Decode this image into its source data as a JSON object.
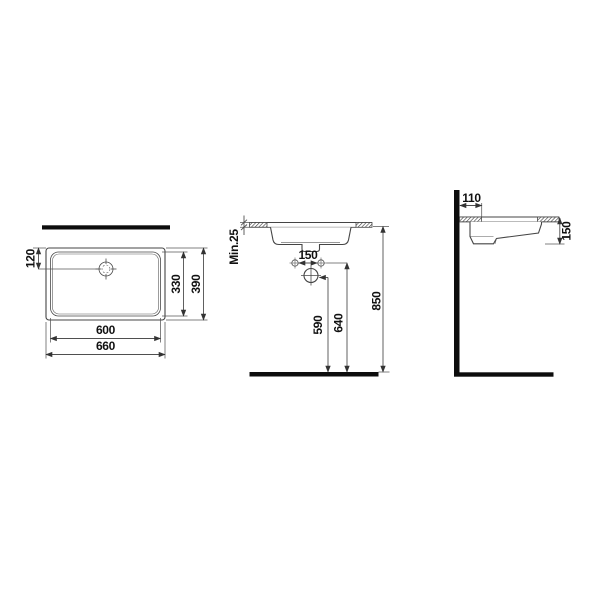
{
  "drawing": {
    "kind": "washbasin-dimension-drawing",
    "colors": {
      "background": "#ffffff",
      "solid_bar": "#0d0d0d",
      "line": "#454545",
      "text": "#111111"
    },
    "views": {
      "plan": {
        "dims": {
          "drain_offset": "120",
          "inner_depth": "330",
          "outer_depth": "390",
          "inner_width": "600",
          "outer_width": "660"
        }
      },
      "front": {
        "dims": {
          "counter_thickness": "Min.25",
          "hole_spacing": "150",
          "drain_height": "590",
          "hole_height": "640",
          "rim_height": "850"
        }
      },
      "side": {
        "dims": {
          "wall_offset": "110",
          "basin_depth": "150"
        }
      }
    }
  }
}
